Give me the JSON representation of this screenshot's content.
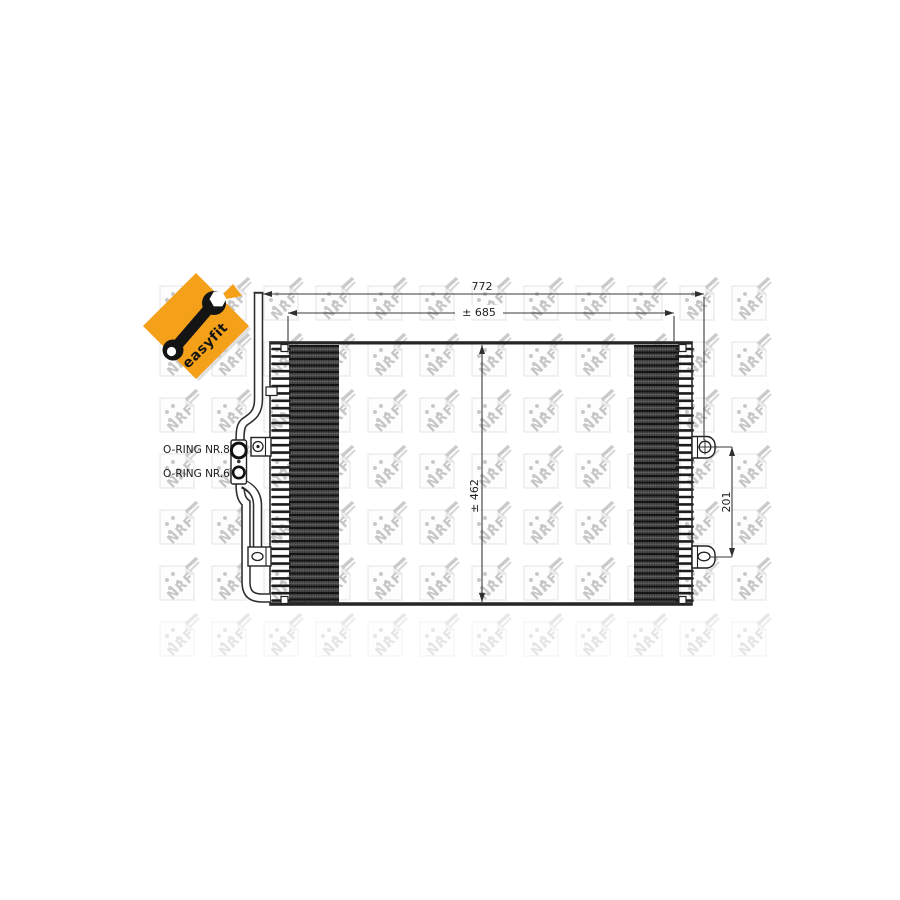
{
  "badge": {
    "label": "easyfit"
  },
  "watermark": {
    "brand": "NRF"
  },
  "dimensions": {
    "overall_width": "772",
    "core_width": "± 685",
    "height": "± 462",
    "bracket_spacing": "201"
  },
  "labels": {
    "oring_top": "O-RING NR.8",
    "oring_bottom": "O-RING NR.6"
  },
  "colors": {
    "accent_orange": "#f5a019",
    "drawing_line": "#2b2b2b",
    "fin_fill": "#4e4e4e",
    "fin_line_dark": "#151515",
    "watermark_gray": "#c8c8c8",
    "watermark_outline": "#e4e4e4"
  }
}
